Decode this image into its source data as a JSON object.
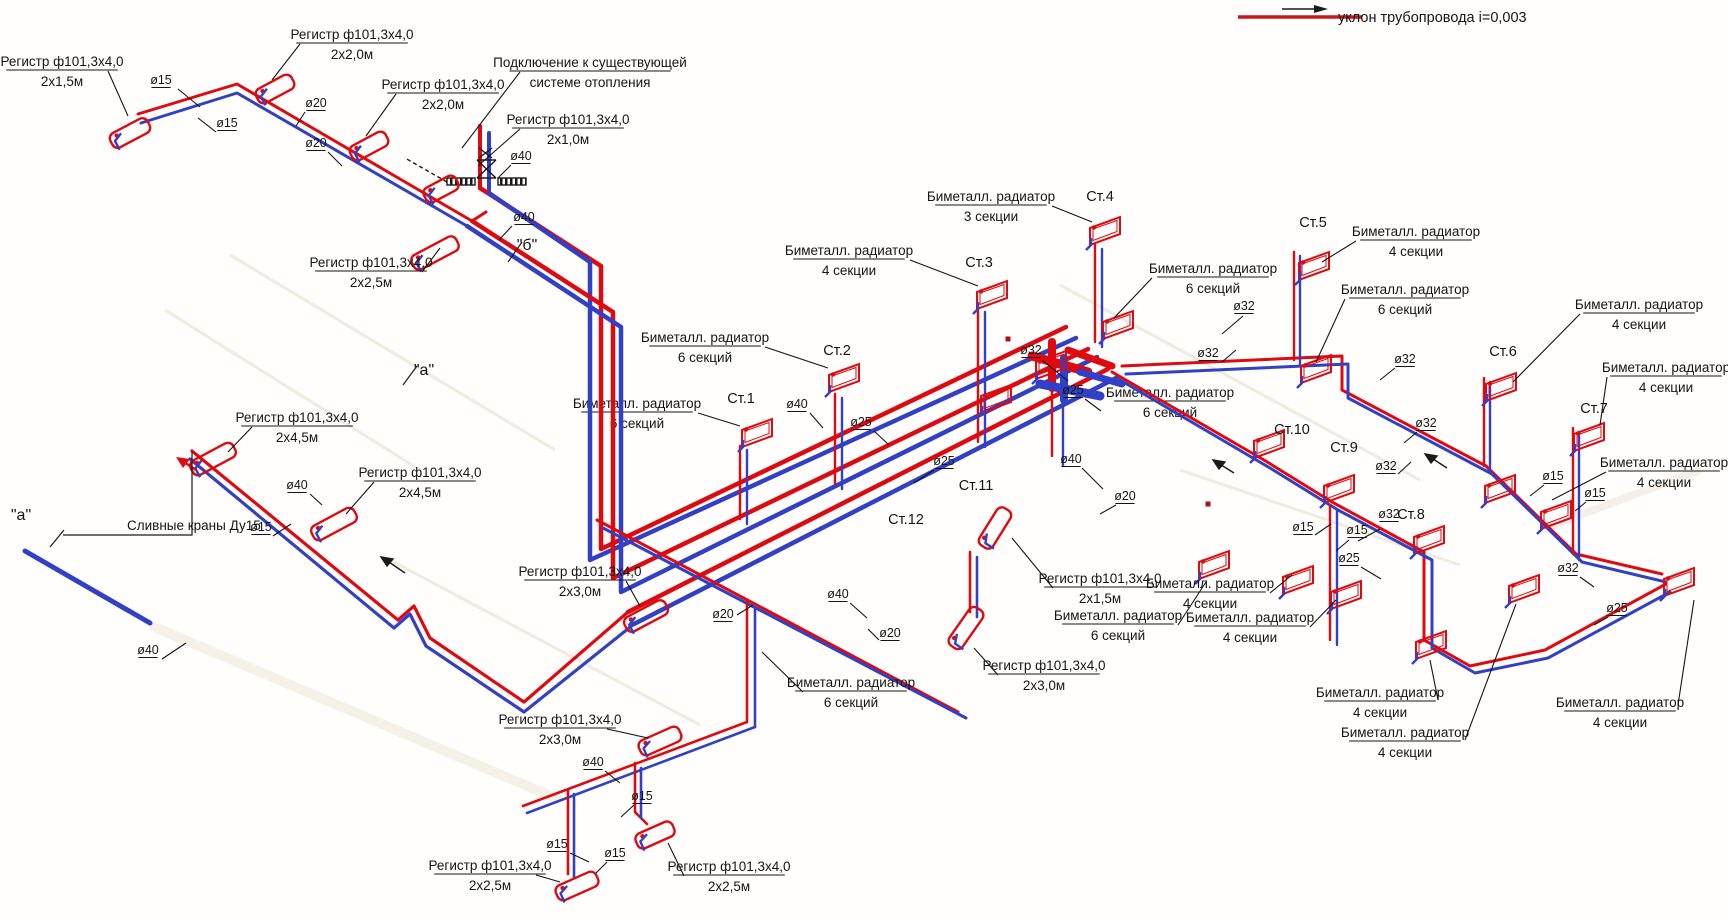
{
  "legend": {
    "label": "уклон трубопровода i=0,003"
  },
  "colors": {
    "supply": "#dd0b10",
    "return": "#3140c6",
    "ink": "#151515"
  },
  "labels": {
    "callouts": [
      {
        "n": "reg-2x1-5-topleft",
        "l1": "Регистр ф101,3х4,0",
        "l2": "2х1,5м",
        "x": 62,
        "y": 66,
        "ld": [
          108,
          71,
          128,
          116
        ]
      },
      {
        "n": "reg-2x2-0-a",
        "l1": "Регистр ф101,3х4,0",
        "l2": "2х2,0м",
        "x": 352,
        "y": 39,
        "ld": [
          300,
          44,
          272,
          80
        ]
      },
      {
        "n": "reg-2x2-0-b",
        "l1": "Регистр ф101,3х4,0",
        "l2": "2х2,0м",
        "x": 443,
        "y": 89,
        "ld": [
          396,
          94,
          366,
          136
        ]
      },
      {
        "n": "connection-existing",
        "l1": "Подключение к существующей",
        "l2": "системе отопления",
        "x": 590,
        "y": 67,
        "ld": [
          520,
          72,
          462,
          148
        ]
      },
      {
        "n": "reg-2x1-0",
        "l1": "Регистр ф101,3х4,0",
        "l2": "2х1,0м",
        "x": 568,
        "y": 124,
        "ld": [
          520,
          129,
          478,
          166
        ]
      },
      {
        "n": "reg-2x2-5-top",
        "l1": "Регистр ф101,3х4,0",
        "l2": "2х2,5м",
        "x": 371,
        "y": 267,
        "ld": [
          422,
          272,
          440,
          248
        ]
      },
      {
        "n": "reg-2x4-5-a",
        "l1": "Регистр ф101,3х4,0",
        "l2": "2х4,5м",
        "x": 297,
        "y": 422,
        "ld": [
          252,
          427,
          228,
          452
        ]
      },
      {
        "n": "reg-2x4-5-b",
        "l1": "Регистр ф101,3х4,0",
        "l2": "2х4,5м",
        "x": 420,
        "y": 477,
        "ld": [
          374,
          482,
          346,
          514
        ]
      },
      {
        "n": "reg-2x3-0-left",
        "l1": "Регистр ф101,3х4,0",
        "l2": "2х3,0м",
        "x": 580,
        "y": 576,
        "ld": [
          626,
          581,
          640,
          606
        ]
      },
      {
        "n": "reg-2x3-0-bottom",
        "l1": "Регистр ф101,3х4,0",
        "l2": "2х3,0м",
        "x": 560,
        "y": 724,
        "ld": [
          607,
          729,
          648,
          738
        ]
      },
      {
        "n": "reg-2x2-5-bot-left",
        "l1": "Регистр ф101,3х4,0",
        "l2": "2х2,5м",
        "x": 490,
        "y": 870,
        "ld": [
          536,
          875,
          560,
          882
        ]
      },
      {
        "n": "reg-2x2-5-bot-right",
        "l1": "Регистр ф101,3х4,0",
        "l2": "2х2,5м",
        "x": 729,
        "y": 871,
        "ld": [
          684,
          876,
          668,
          843
        ]
      },
      {
        "n": "reg-2x1-5-right",
        "l1": "Регистр ф101,3х4,0",
        "l2": "2х1,5м",
        "x": 1100,
        "y": 583,
        "ld": [
          1053,
          588,
          1012,
          538
        ]
      },
      {
        "n": "reg-2x3-0-right",
        "l1": "Регистр ф101,3х4,0",
        "l2": "2х3,0м",
        "x": 1044,
        "y": 670,
        "ld": [
          998,
          675,
          974,
          648
        ]
      },
      {
        "n": "bim-6-st2",
        "l1": "Биметалл. радиатор",
        "l2": "6 секций",
        "x": 705,
        "y": 342,
        "ld": [
          765,
          347,
          828,
          368
        ]
      },
      {
        "n": "bim-6-st1",
        "l1": "Биметалл. радиатор",
        "l2": "6 секций",
        "x": 637,
        "y": 408,
        "behind": true,
        "ld": [
          698,
          413,
          740,
          426
        ]
      },
      {
        "n": "bim-4-st3",
        "l1": "Биметалл. радиатор",
        "l2": "4 секции",
        "x": 849,
        "y": 255,
        "ld": [
          910,
          260,
          978,
          286
        ]
      },
      {
        "n": "bim-3-st4",
        "l1": "Биметалл. радиатор",
        "l2": "3 секции",
        "x": 991,
        "y": 201,
        "ld": [
          1052,
          206,
          1092,
          222
        ]
      },
      {
        "n": "bim-6-st4b",
        "l1": "Биметалл. радиатор",
        "l2": "6 секций",
        "x": 1213,
        "y": 273,
        "ld": [
          1152,
          278,
          1114,
          318
        ]
      },
      {
        "n": "bim-4-st5",
        "l1": "Биметалл. радиатор",
        "l2": "4 секции",
        "x": 1416,
        "y": 236,
        "ld": [
          1356,
          241,
          1322,
          262
        ]
      },
      {
        "n": "bim-6-st5b",
        "l1": "Биметалл. радиатор",
        "l2": "6 секций",
        "x": 1405,
        "y": 294,
        "ld": [
          1345,
          299,
          1316,
          362
        ]
      },
      {
        "n": "bim-4-st6",
        "l1": "Биметалл. радиатор",
        "l2": "4 секции",
        "x": 1639,
        "y": 309,
        "ld": [
          1580,
          314,
          1513,
          382
        ]
      },
      {
        "n": "bim-4-st7",
        "l1": "Биметалл. радиатор",
        "l2": "4 секции",
        "x": 1666,
        "y": 372,
        "ld": [
          1607,
          377,
          1600,
          425
        ]
      },
      {
        "n": "bim-4-st7b",
        "l1": "Биметалл. радиатор",
        "l2": "4 секции",
        "x": 1664,
        "y": 467,
        "ld": [
          1606,
          472,
          1552,
          500
        ]
      },
      {
        "n": "bim-junction",
        "l1": "Биметалл. радиатор",
        "l2": "6 секций",
        "x": 1170,
        "y": 397,
        "behind": true
      },
      {
        "n": "bim-4-mid-a",
        "l1": "Биметалл. радиатор",
        "l2": "4 секции",
        "x": 1210,
        "y": 588,
        "ld": [
          1270,
          593,
          1292,
          575
        ]
      },
      {
        "n": "bim-6-mid-b",
        "l1": "Биметалл. радиатор",
        "l2": "6 секций",
        "x": 1118,
        "y": 620,
        "ld": [
          1178,
          625,
          1206,
          582
        ]
      },
      {
        "n": "bim-4-mid-c",
        "l1": "Биметалл. радиатор",
        "l2": "4 секции",
        "x": 1250,
        "y": 622,
        "ld": [
          1310,
          627,
          1336,
          600
        ]
      },
      {
        "n": "bim-4-bot-d",
        "l1": "Биметалл. радиатор",
        "l2": "4 секции",
        "x": 1380,
        "y": 697,
        "ld": [
          1438,
          700,
          1430,
          660
        ]
      },
      {
        "n": "bim-4-bot-e",
        "l1": "Биметалл. радиатор",
        "l2": "4 секции",
        "x": 1405,
        "y": 737,
        "ld": [
          1465,
          740,
          1516,
          604
        ]
      },
      {
        "n": "bim-4-bot-f",
        "l1": "Биметалл. радиатор",
        "l2": "4 секции",
        "x": 1620,
        "y": 707,
        "ld": [
          1678,
          705,
          1694,
          600
        ]
      },
      {
        "n": "bim-6-bot-g",
        "l1": "Биметалл. радиатор",
        "l2": "6 секций",
        "x": 851,
        "y": 687,
        "ld": [
          803,
          692,
          762,
          652
        ]
      }
    ],
    "diameters": [
      {
        "n": "d15-a",
        "t": "ø15",
        "x": 161,
        "y": 84,
        "ld": [
          178,
          89,
          200,
          107
        ]
      },
      {
        "n": "d15-b",
        "t": "ø15",
        "x": 227,
        "y": 127,
        "ld": [
          216,
          132,
          198,
          118
        ]
      },
      {
        "n": "d20-a",
        "t": "ø20",
        "x": 316,
        "y": 107,
        "ld": [
          305,
          112,
          296,
          126
        ]
      },
      {
        "n": "d20-b",
        "t": "ø20",
        "x": 316,
        "y": 147,
        "ld": [
          328,
          152,
          342,
          166
        ]
      },
      {
        "n": "d40-a",
        "t": "ø40",
        "x": 521,
        "y": 160,
        "ld": [
          511,
          165,
          498,
          178
        ]
      },
      {
        "n": "d40-b",
        "t": "ø40",
        "x": 524,
        "y": 221,
        "ld": [
          512,
          226,
          499,
          240
        ]
      },
      {
        "n": "d40-c",
        "t": "ø40",
        "x": 297,
        "y": 489,
        "ld": [
          310,
          494,
          322,
          505
        ]
      },
      {
        "n": "d15-c",
        "t": "ø15",
        "x": 261,
        "y": 531,
        "ld": [
          273,
          536,
          291,
          524
        ]
      },
      {
        "n": "d40-d",
        "t": "ø40",
        "x": 148,
        "y": 654,
        "ld": [
          162,
          659,
          186,
          643
        ]
      },
      {
        "n": "d40-e",
        "t": "ø40",
        "x": 797,
        "y": 408,
        "ld": [
          810,
          413,
          823,
          428
        ]
      },
      {
        "n": "d25-a",
        "t": "ø25",
        "x": 861,
        "y": 426,
        "ld": [
          874,
          431,
          889,
          445
        ]
      },
      {
        "n": "d25-b",
        "t": "ø25",
        "x": 944,
        "y": 465,
        "ld": [
          934,
          470,
          914,
          483
        ]
      },
      {
        "n": "d40-f",
        "t": "ø40",
        "x": 1071,
        "y": 463,
        "ld": [
          1082,
          468,
          1103,
          489
        ]
      },
      {
        "n": "d20-c",
        "t": "ø20",
        "x": 1125,
        "y": 500,
        "ld": [
          1116,
          505,
          1100,
          514
        ]
      },
      {
        "n": "d40-g",
        "t": "ø40",
        "x": 838,
        "y": 598,
        "ld": [
          850,
          603,
          867,
          618
        ]
      },
      {
        "n": "d20-d",
        "t": "ø20",
        "x": 723,
        "y": 618,
        "ld": [
          737,
          615,
          753,
          605
        ]
      },
      {
        "n": "d20-e",
        "t": "ø20",
        "x": 890,
        "y": 637,
        "ld": [
          879,
          640,
          868,
          629
        ]
      },
      {
        "n": "d32-a",
        "t": "ø32",
        "x": 1031,
        "y": 354,
        "ld": [
          1042,
          360,
          1068,
          381
        ]
      },
      {
        "n": "d25-c",
        "t": "ø25",
        "x": 1073,
        "y": 394,
        "ld": [
          1085,
          399,
          1101,
          411
        ]
      },
      {
        "n": "d32-b",
        "t": "ø32",
        "x": 1208,
        "y": 357,
        "ld": [
          1222,
          362,
          1236,
          350
        ]
      },
      {
        "n": "d32-c",
        "t": "ø32",
        "x": 1244,
        "y": 310,
        "ld": [
          1243,
          316,
          1222,
          334
        ]
      },
      {
        "n": "d32-d",
        "t": "ø32",
        "x": 1405,
        "y": 363,
        "ld": [
          1395,
          368,
          1380,
          380
        ]
      },
      {
        "n": "d32-e",
        "t": "ø32",
        "x": 1426,
        "y": 427,
        "ld": [
          1417,
          432,
          1404,
          443
        ]
      },
      {
        "n": "d32-f",
        "t": "ø32",
        "x": 1386,
        "y": 470,
        "ld": [
          1398,
          474,
          1411,
          462
        ]
      },
      {
        "n": "d32-g",
        "t": "ø32",
        "x": 1389,
        "y": 518,
        "ld": [
          1380,
          529,
          1358,
          541
        ]
      },
      {
        "n": "d15-d",
        "t": "ø15",
        "x": 1303,
        "y": 531,
        "ld": [
          1315,
          535,
          1331,
          524
        ]
      },
      {
        "n": "d15-e",
        "t": "ø15",
        "x": 1357,
        "y": 534,
        "ld": [
          1349,
          540,
          1336,
          551
        ]
      },
      {
        "n": "d25-d",
        "t": "ø25",
        "x": 1349,
        "y": 562,
        "ld": [
          1361,
          567,
          1381,
          579
        ]
      },
      {
        "n": "d15-f",
        "t": "ø15",
        "x": 1553,
        "y": 480,
        "ld": [
          1544,
          485,
          1530,
          496
        ]
      },
      {
        "n": "d15-g",
        "t": "ø15",
        "x": 1595,
        "y": 497,
        "ld": [
          1586,
          502,
          1575,
          511
        ]
      },
      {
        "n": "d32-h",
        "t": "ø32",
        "x": 1568,
        "y": 572,
        "ld": [
          1580,
          577,
          1594,
          587
        ]
      },
      {
        "n": "d25-e",
        "t": "ø25",
        "x": 1617,
        "y": 612,
        "ld": [
          1608,
          617,
          1594,
          625
        ]
      },
      {
        "n": "d40-h",
        "t": "ø40",
        "x": 593,
        "y": 766,
        "ld": [
          605,
          771,
          620,
          783
        ]
      },
      {
        "n": "d15-h",
        "t": "ø15",
        "x": 642,
        "y": 800,
        "ld": [
          634,
          805,
          621,
          817
        ]
      },
      {
        "n": "d15-i",
        "t": "ø15",
        "x": 557,
        "y": 848,
        "ld": [
          570,
          853,
          589,
          862
        ]
      },
      {
        "n": "d15-j",
        "t": "ø15",
        "x": 615,
        "y": 857,
        "ld": [
          607,
          862,
          596,
          873
        ]
      }
    ],
    "risers": [
      {
        "n": "st1",
        "t": "Ст.1",
        "x": 741,
        "y": 403
      },
      {
        "n": "st2",
        "t": "Ст.2",
        "x": 837,
        "y": 355
      },
      {
        "n": "st3",
        "t": "Ст.3",
        "x": 979,
        "y": 267
      },
      {
        "n": "st4",
        "t": "Ст.4",
        "x": 1100,
        "y": 201
      },
      {
        "n": "st5",
        "t": "Ст.5",
        "x": 1313,
        "y": 227
      },
      {
        "n": "st6",
        "t": "Ст.6",
        "x": 1503,
        "y": 356
      },
      {
        "n": "st7",
        "t": "Ст.7",
        "x": 1594,
        "y": 413
      },
      {
        "n": "st8",
        "t": "Ст.8",
        "x": 1411,
        "y": 519
      },
      {
        "n": "st9",
        "t": "Ст.9",
        "x": 1344,
        "y": 452
      },
      {
        "n": "st10",
        "t": "Ст.10",
        "x": 1292,
        "y": 434
      },
      {
        "n": "st11",
        "t": "Ст.11",
        "x": 976,
        "y": 490,
        "behind": true
      },
      {
        "n": "st12",
        "t": "Ст.12",
        "x": 906,
        "y": 524,
        "behind": true
      }
    ],
    "marks": [
      {
        "n": "section-b",
        "t": "\"б\"",
        "x": 527,
        "y": 250
      },
      {
        "n": "section-a-mid",
        "t": "\"а\"",
        "x": 424,
        "y": 375
      },
      {
        "n": "section-a-left",
        "t": "\"а\"",
        "x": 21,
        "y": 520
      }
    ],
    "drain": {
      "n": "drain-valves",
      "t": "Сливные краны Ду15",
      "x": 127,
      "y": 530
    }
  },
  "symbols": {
    "radiators": [
      {
        "x": 742,
        "y": 419
      },
      {
        "x": 829,
        "y": 364
      },
      {
        "x": 977,
        "y": 281
      },
      {
        "x": 1090,
        "y": 217
      },
      {
        "x": 1103,
        "y": 311
      },
      {
        "x": 1299,
        "y": 252
      },
      {
        "x": 1301,
        "y": 355
      },
      {
        "x": 1486,
        "y": 373
      },
      {
        "x": 1485,
        "y": 475
      },
      {
        "x": 1574,
        "y": 423
      },
      {
        "x": 1541,
        "y": 501
      },
      {
        "x": 1414,
        "y": 526
      },
      {
        "x": 1416,
        "y": 631
      },
      {
        "x": 1324,
        "y": 475
      },
      {
        "x": 1331,
        "y": 581
      },
      {
        "x": 1254,
        "y": 430
      },
      {
        "x": 1664,
        "y": 568
      },
      {
        "x": 1509,
        "y": 575
      },
      {
        "x": 1283,
        "y": 566
      },
      {
        "x": 1199,
        "y": 551
      },
      {
        "x": 1036,
        "y": 351
      },
      {
        "x": 981,
        "y": 385
      }
    ],
    "registers": [
      {
        "x": 130,
        "y": 133,
        "a": -28,
        "l": 42
      },
      {
        "x": 275,
        "y": 89,
        "a": -28,
        "l": 40
      },
      {
        "x": 369,
        "y": 146,
        "a": -28,
        "l": 40
      },
      {
        "x": 441,
        "y": 189,
        "a": -28,
        "l": 36
      },
      {
        "x": 435,
        "y": 253,
        "a": -28,
        "l": 50
      },
      {
        "x": 213,
        "y": 459,
        "a": -28,
        "l": 48
      },
      {
        "x": 334,
        "y": 524,
        "a": -28,
        "l": 48
      },
      {
        "x": 646,
        "y": 616,
        "a": -28,
        "l": 46
      },
      {
        "x": 660,
        "y": 741,
        "a": -24,
        "l": 44
      },
      {
        "x": 577,
        "y": 886,
        "a": -24,
        "l": 44
      },
      {
        "x": 655,
        "y": 835,
        "a": -24,
        "l": 40
      },
      {
        "x": 995,
        "y": 528,
        "a": -58,
        "l": 44
      },
      {
        "x": 966,
        "y": 628,
        "a": -55,
        "l": 46
      }
    ],
    "dots": [
      {
        "x": 1008,
        "y": 339
      },
      {
        "x": 1208,
        "y": 504
      }
    ]
  }
}
